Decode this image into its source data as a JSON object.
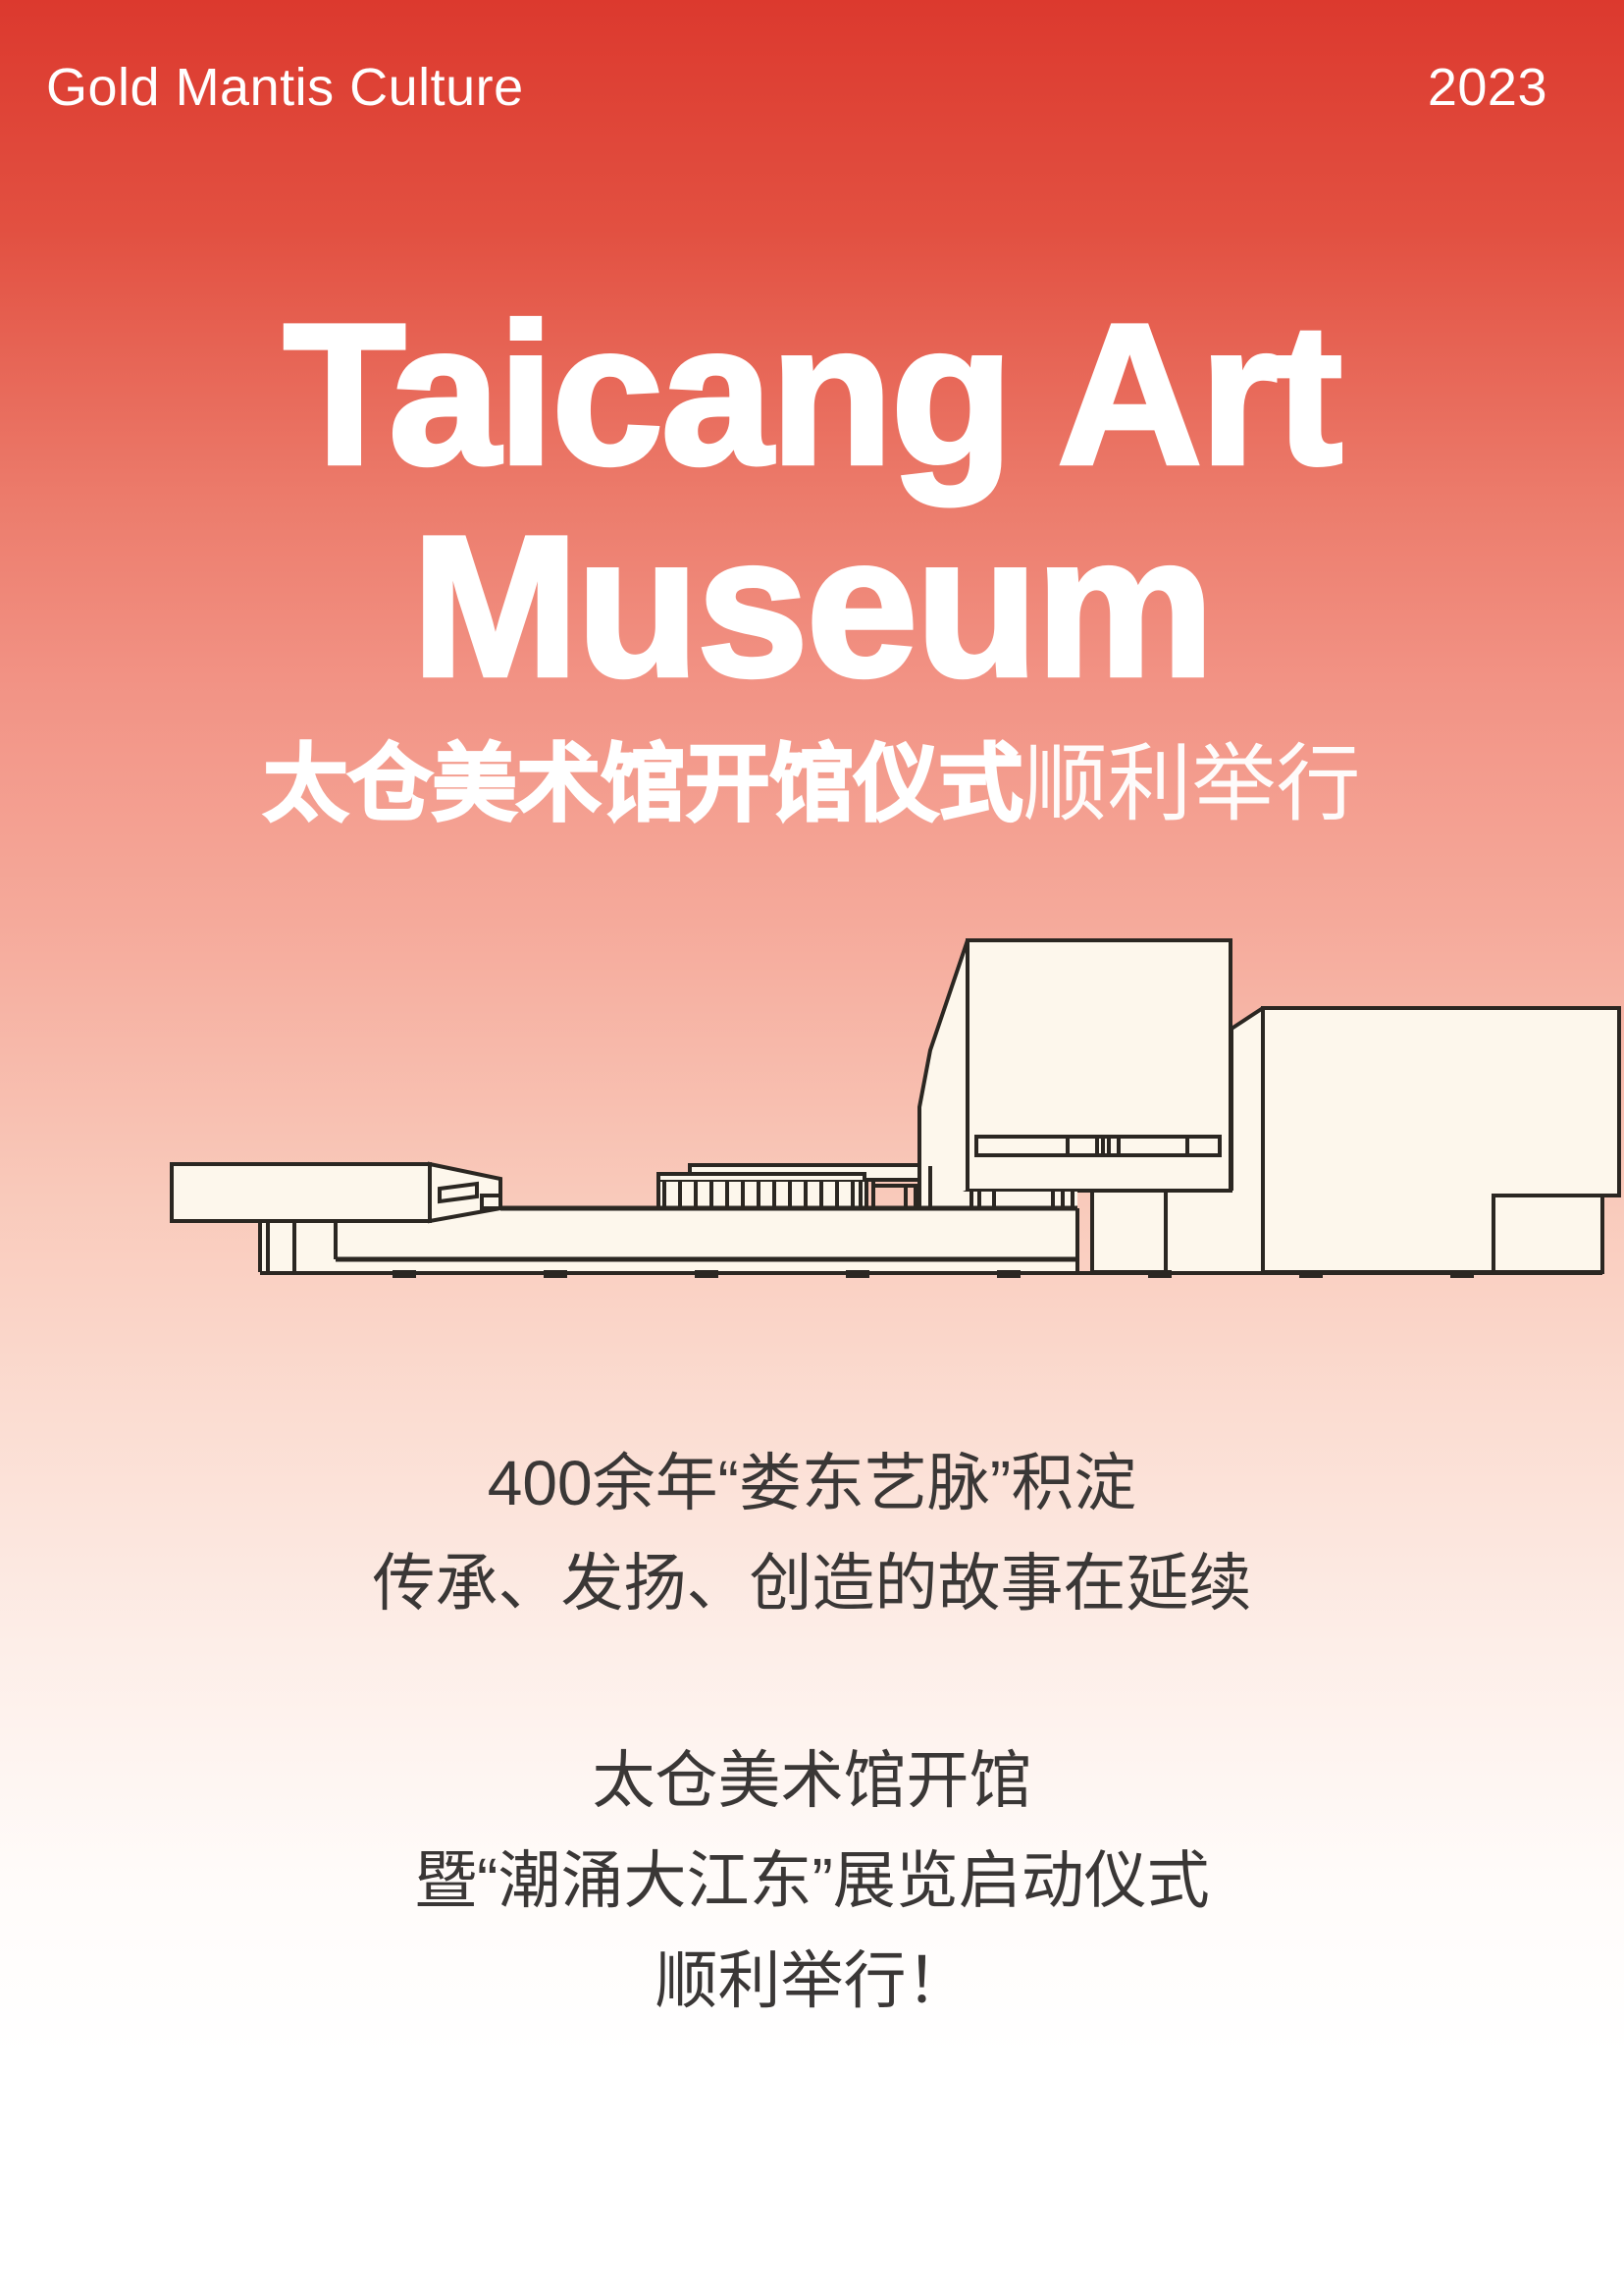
{
  "header": {
    "brand": "Gold Mantis Culture",
    "year": "2023"
  },
  "hero": {
    "title_line1": "Taicang Art",
    "title_line2": "Museum",
    "subtitle_bold": "太仓美术馆开馆仪式",
    "subtitle_light": "顺利举行"
  },
  "illustration": {
    "subject": "Taicang Art Museum building line drawing",
    "fill_color": "#fdf7ec",
    "line_color": "#2b2722"
  },
  "content": {
    "intro": [
      "400余年“娄东艺脉”积淀",
      "传承、发扬、创造的故事在延续"
    ],
    "announcement": [
      "太仓美术馆开馆",
      "暨“潮涌大江东”展览启动仪式",
      "顺利举行！"
    ]
  },
  "colors": {
    "gradient_top": "#dc392e",
    "gradient_mid": "#f29385",
    "gradient_bottom": "#ffffff",
    "header_text": "#ffffff",
    "title_text": "#ffffff",
    "body_text": "#3a3736"
  }
}
